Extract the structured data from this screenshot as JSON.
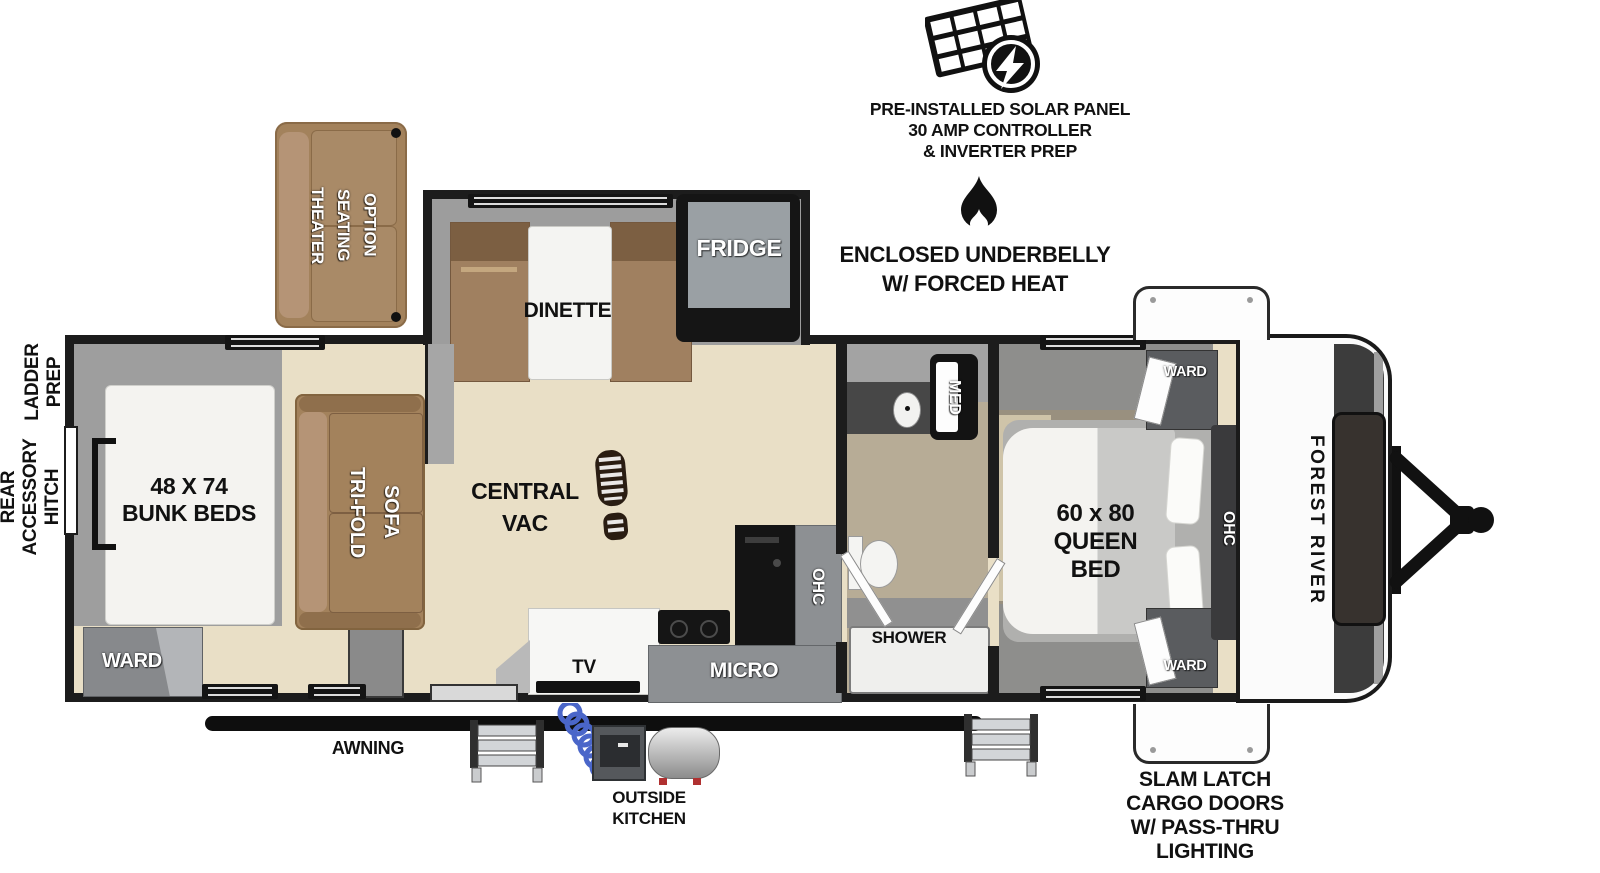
{
  "title": "Travel trailer floor plan",
  "callouts": {
    "solar": "PRE-INSTALLED SOLAR PANEL\n30 AMP CONTROLLER\n& INVERTER PREP",
    "underbelly": "ENCLOSED UNDERBELLY\nW/ FORCED HEAT",
    "ladder_prep": "LADDER\nPREP",
    "rear_hitch": "REAR\nACCESSORY\nHITCH",
    "awning": "AWNING",
    "outside_kitchen": "OUTSIDE\nKITCHEN",
    "slam_latch": "SLAM LATCH\nCARGO DOORS\nW/ PASS-THRU\nLIGHTING"
  },
  "furniture": {
    "theater": "THEATER\nSEATING\nOPTION",
    "dinette": "DINETTE",
    "fridge": "FRIDGE",
    "bunk_beds": "48 X 74\nBUNK BEDS",
    "ward_bunk": "WARD",
    "trifold_sofa": "TRI-FOLD\nSOFA",
    "central_vac": "CENTRAL\nVAC",
    "tv": "TV",
    "micro": "MICRO",
    "ohc_kitchen": "OHC",
    "med": "MED",
    "shower": "SHOWER",
    "queen_bed": "60 x 80\nQUEEN\nBED",
    "ward_front_top": "WARD",
    "ward_front_bottom": "WARD",
    "ohc_bedroom": "OHC",
    "brand": "FOREST RIVER"
  },
  "icons": [
    "solar-panel-icon",
    "flame-icon",
    "bootprint-icon",
    "entry-steps-icon",
    "coiled-hose-icon",
    "hitch-icon"
  ],
  "colors": {
    "wall": "#1c1c1c",
    "floor_tan": "#e9dfc6",
    "interior_gray": "#9e9e9e",
    "sofa_brown": "#a3825c",
    "bench_brown": "#a08060",
    "cabinet_gray": "#8d9093",
    "appliance_black": "#141414",
    "mattress_white": "#f4f3f0",
    "hose_blue": "#4a66c9",
    "tank_red_feet": "#b03030"
  }
}
